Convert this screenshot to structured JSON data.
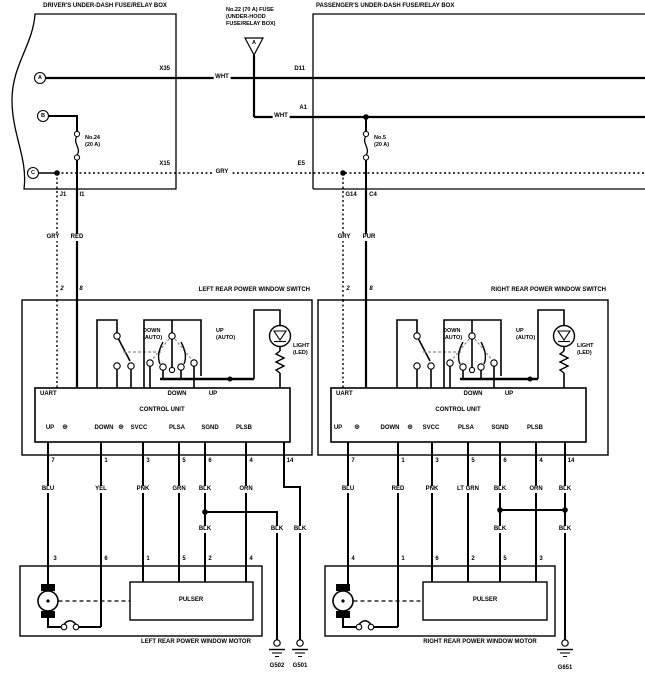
{
  "colors": {
    "line": "#000000",
    "background": "#ffffff"
  },
  "top": {
    "driver_box_title": "DRIVER'S UNDER-DASH FUSE/RELAY BOX",
    "passenger_box_title": "PASSENGER'S UNDER-DASH FUSE/RELAY BOX",
    "underhood_fuse": {
      "line1": "No.22 (70 A) FUSE",
      "line2": "(UNDER-HOOD",
      "line3": "FUSE/RELAY BOX)",
      "triangle_letter": "A"
    },
    "terminals": {
      "a": "A",
      "b": "B",
      "c": "C"
    },
    "fuse24": {
      "name": "No.24",
      "rating": "(20 A)"
    },
    "fuse5": {
      "name": "No.5",
      "rating": "(20 A)"
    },
    "connectors": {
      "x35": "X35",
      "d11": "D11",
      "a1": "A1",
      "x15": "X15",
      "e5": "E5",
      "j1": "J1",
      "i1": "I1",
      "g14": "G14",
      "c4": "C4"
    },
    "wire_wht_1": "WHT",
    "wire_wht_2": "WHT",
    "wire_gry": "GRY"
  },
  "switch_internal": {
    "down_auto_l1": "DOWN",
    "down_auto_l2": "(AUTO)",
    "up_auto_l1": "UP",
    "up_auto_l2": "(AUTO)",
    "light_l1": "LIGHT",
    "light_l2": "(LED)",
    "uart": "UART",
    "down": "DOWN",
    "up": "UP",
    "control_unit": "CONTROL UNIT",
    "terms": [
      "UP",
      "DOWN",
      "SVCC",
      "PLSA",
      "SGND",
      "PLSB"
    ],
    "plus_symbol": "⊕"
  },
  "left": {
    "switch_title": "LEFT REAR POWER WINDOW SWITCH",
    "feed_pins": [
      "2",
      "8"
    ],
    "feed_colors": [
      "GRY",
      "RED"
    ],
    "out_pins": [
      "7",
      "1",
      "3",
      "5",
      "6",
      "4",
      "14"
    ],
    "out_colors": [
      "BLU",
      "YEL",
      "PNK",
      "GRN",
      "BLK",
      "ORN"
    ],
    "gnd_colors": [
      "BLK",
      "BLK",
      "BLK"
    ],
    "motor_pins": [
      "3",
      "6",
      "1",
      "5",
      "2",
      "4"
    ],
    "pulser": "PULSER",
    "motor_title": "LEFT REAR POWER WINDOW MOTOR",
    "grounds": [
      "G502",
      "G501"
    ]
  },
  "right": {
    "switch_title": "RIGHT REAR POWER WINDOW SWITCH",
    "feed_pins": [
      "2",
      "8"
    ],
    "feed_colors": [
      "GRY",
      "PUR"
    ],
    "out_pins": [
      "7",
      "1",
      "3",
      "5",
      "6",
      "4",
      "14"
    ],
    "out_colors": [
      "BLU",
      "RED",
      "PNK",
      "LT GRN",
      "BLK",
      "ORN",
      "BLK"
    ],
    "gnd_colors": [
      "BLK",
      "BLK"
    ],
    "motor_pins": [
      "4",
      "1",
      "6",
      "2",
      "5",
      "3"
    ],
    "pulser": "PULSER",
    "motor_title": "RIGHT REAR POWER WINDOW MOTOR",
    "grounds": [
      "G651"
    ]
  }
}
